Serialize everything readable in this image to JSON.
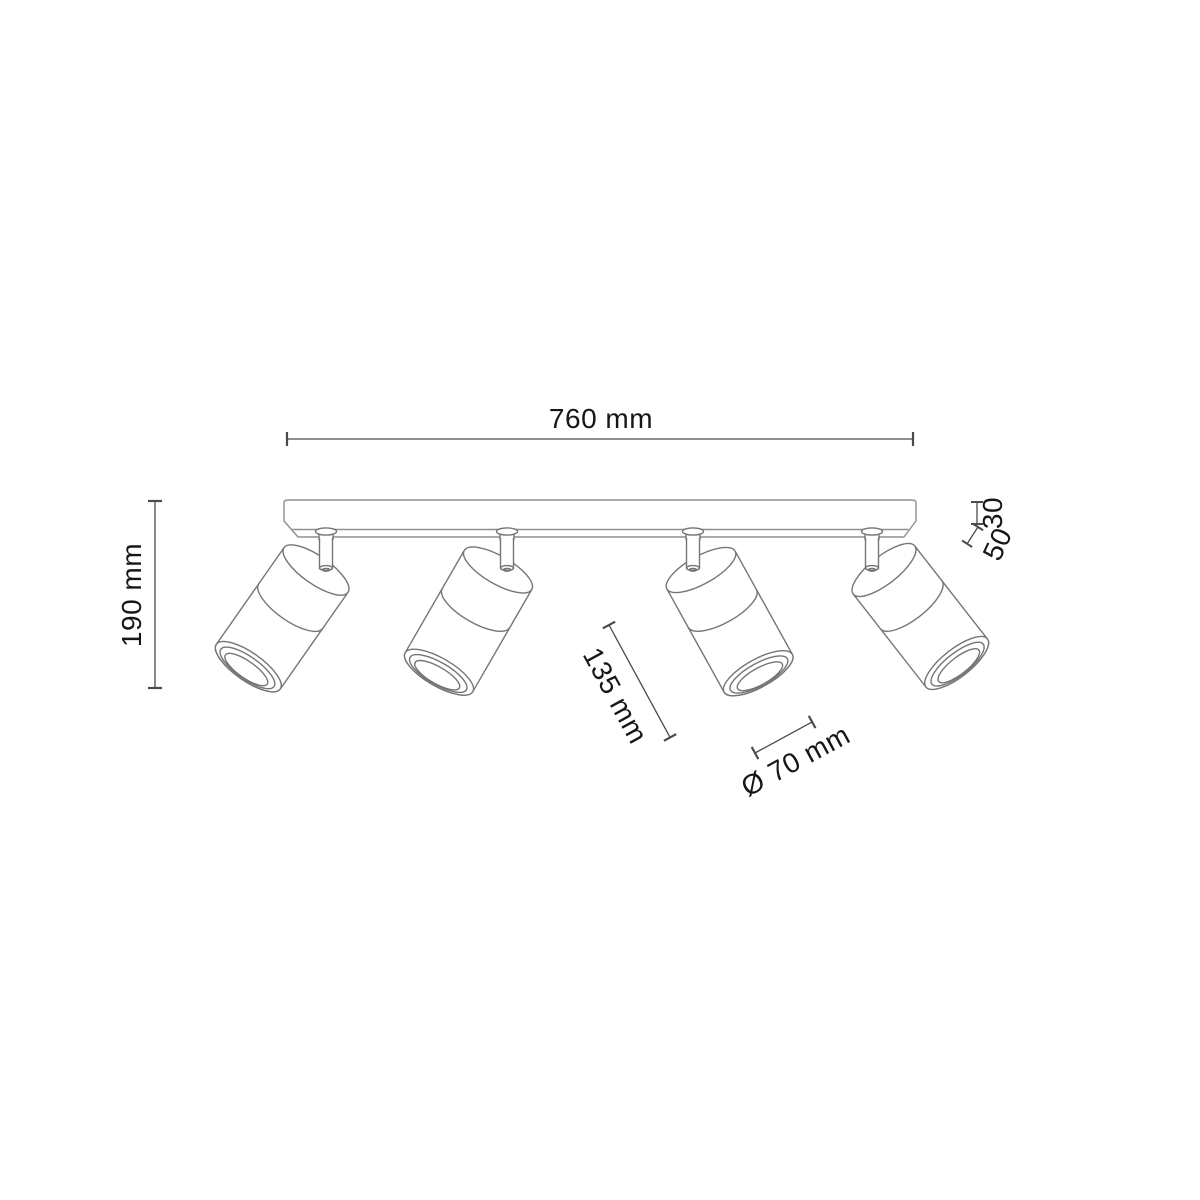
{
  "drawing": {
    "kind": "technical-dimension-diagram",
    "spot_count": 4,
    "labels": {
      "width": "760 mm",
      "height": "190 mm",
      "canopy_thickness": "30",
      "joint": "50",
      "head_length": "135 mm",
      "head_diameter": "Ø 70 mm"
    },
    "colors": {
      "background": "#ffffff",
      "fixture_line": "#757575",
      "rail_line": "#8f8f8f",
      "dimension_line": "#4b4b4b",
      "text": "#161616"
    }
  }
}
